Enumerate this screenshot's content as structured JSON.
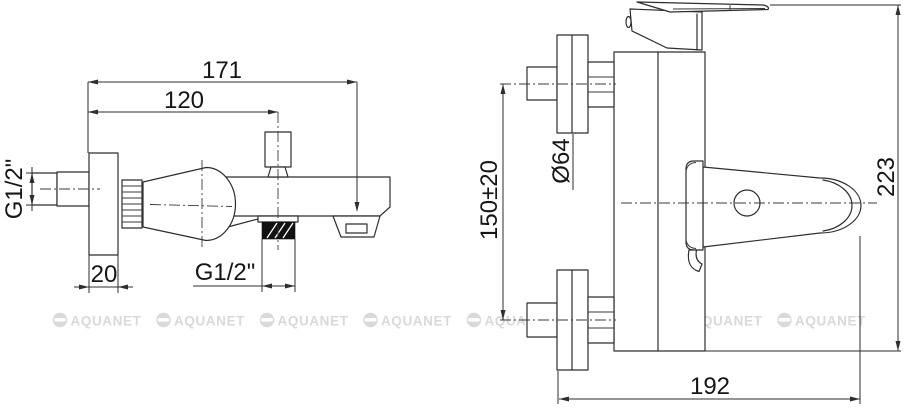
{
  "drawing": {
    "side_view": {
      "dims": {
        "total_length": "171",
        "diverter_offset": "120",
        "plate_depth": "20",
        "inlet_thread": "G1/2\"",
        "outlet_thread": "G1/2\""
      }
    },
    "front_view": {
      "dims": {
        "flange_diameter": "Ø64",
        "inlet_spacing": "150±20",
        "total_height": "223",
        "total_width": "192"
      }
    }
  },
  "watermark": {
    "text": "AQUANET",
    "count": 8
  },
  "colors": {
    "line": "#2e2e2e",
    "centerline": "#3a3a3a",
    "text": "#161616",
    "watermark": "#d9d9d9",
    "background": "#ffffff",
    "thread_fill": "#111111"
  }
}
